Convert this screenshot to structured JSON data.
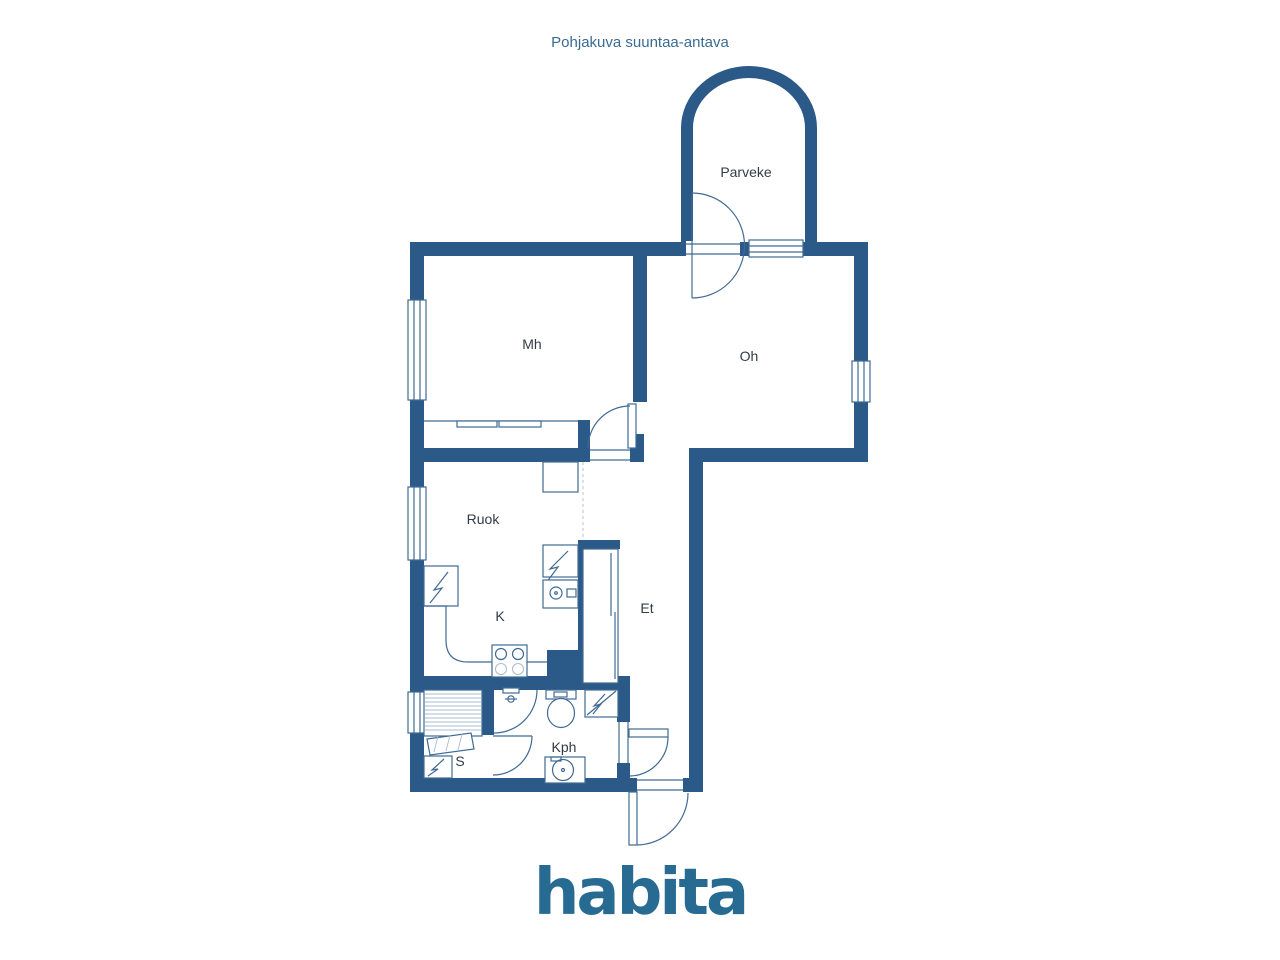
{
  "title": "Pohjakuva suuntaa-antava",
  "logo_text": "habita",
  "rooms": {
    "parveke": "Parveke",
    "mh": "Mh",
    "oh": "Oh",
    "ruok": "Ruok",
    "k": "K",
    "et": "Et",
    "s": "S",
    "kph": "Kph"
  },
  "colors": {
    "wall": "#2b5a88",
    "fixture_line": "#3f6a93",
    "light_line": "#a9bccd",
    "label_text": "#333b43",
    "title_text": "#3b6b92",
    "logo": "#276b92",
    "background": "#ffffff"
  }
}
